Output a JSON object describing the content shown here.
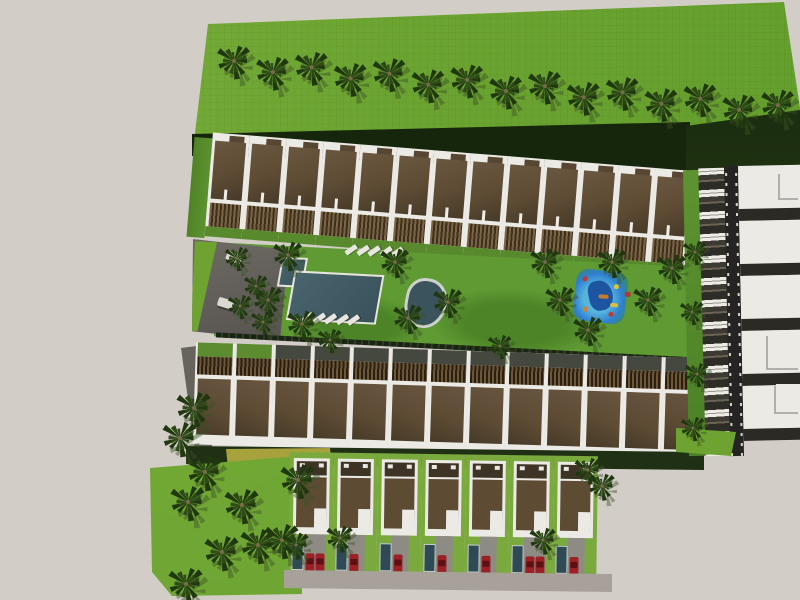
{
  "meta": {
    "description": "Top-down aerial 3D architectural rendering of a residential community: two long rows of brown-roofed townhouses around a central amenity garden with swimming pool, ornamental pond, playground and palm trees; a southern row of detached villas with red cars in driveways; an eastern service road with a column of villas; large bright-green lawns with rows of palms on the north and southwest.",
    "view": "aerial top-down",
    "visible_text": []
  },
  "palette": {
    "canvas_bg": "#d3cdc7",
    "field_green": "#6ca431",
    "lawn_green": "#5f9a33",
    "lot_green": "#7aa93e",
    "hedge_dark": "#203015",
    "shadow_band": "#16260c",
    "roof_brown": "#5d4b34",
    "wall_white": "#eceae5",
    "deck_wood": "#7c6442",
    "pergola_dark": "#272013",
    "pool_water": "#3a525b",
    "pond_water": "#3b535c",
    "pond_rim": "#ccd1cb",
    "plaza_gray": "#6e6b64",
    "road_dark": "#252422",
    "drive_gray": "#8e8b84",
    "bottom_road": "#a8a199",
    "car_red": "#9c2126",
    "palm_frond": "#1f3810",
    "palm_shadow": "#3c5226",
    "playground_blue": "#57b5dd",
    "playground_deep": "#1d55a0",
    "lounger_white": "#e9e6e0",
    "accent_yellow": "#a8a23c"
  },
  "scene": {
    "top_field": {
      "palm_count": 15
    },
    "upper_row": {
      "unit_count": 13,
      "facing": "south toward garden"
    },
    "amenity": {
      "has_pool": true,
      "has_pond": true,
      "has_playground": true,
      "lounger_rows": [
        5,
        5
      ],
      "equipment_count": 3,
      "palm_count": 14,
      "plaza_palm_count": 4,
      "plaza_object_count": 2
    },
    "lower_row": {
      "unit_count": 13,
      "facing": "north toward garden"
    },
    "bottom_row": {
      "house_count": 7,
      "cars_per_lot": [
        2,
        1,
        1,
        1,
        1,
        2,
        1
      ],
      "palm_count": 5
    },
    "right_block": {
      "house_count": 5,
      "balcony_segment_count": 13,
      "has_road": true,
      "palm_count": 4,
      "protrusion_count": 3
    },
    "southwest_lawn": {
      "palm_count": 10
    }
  }
}
